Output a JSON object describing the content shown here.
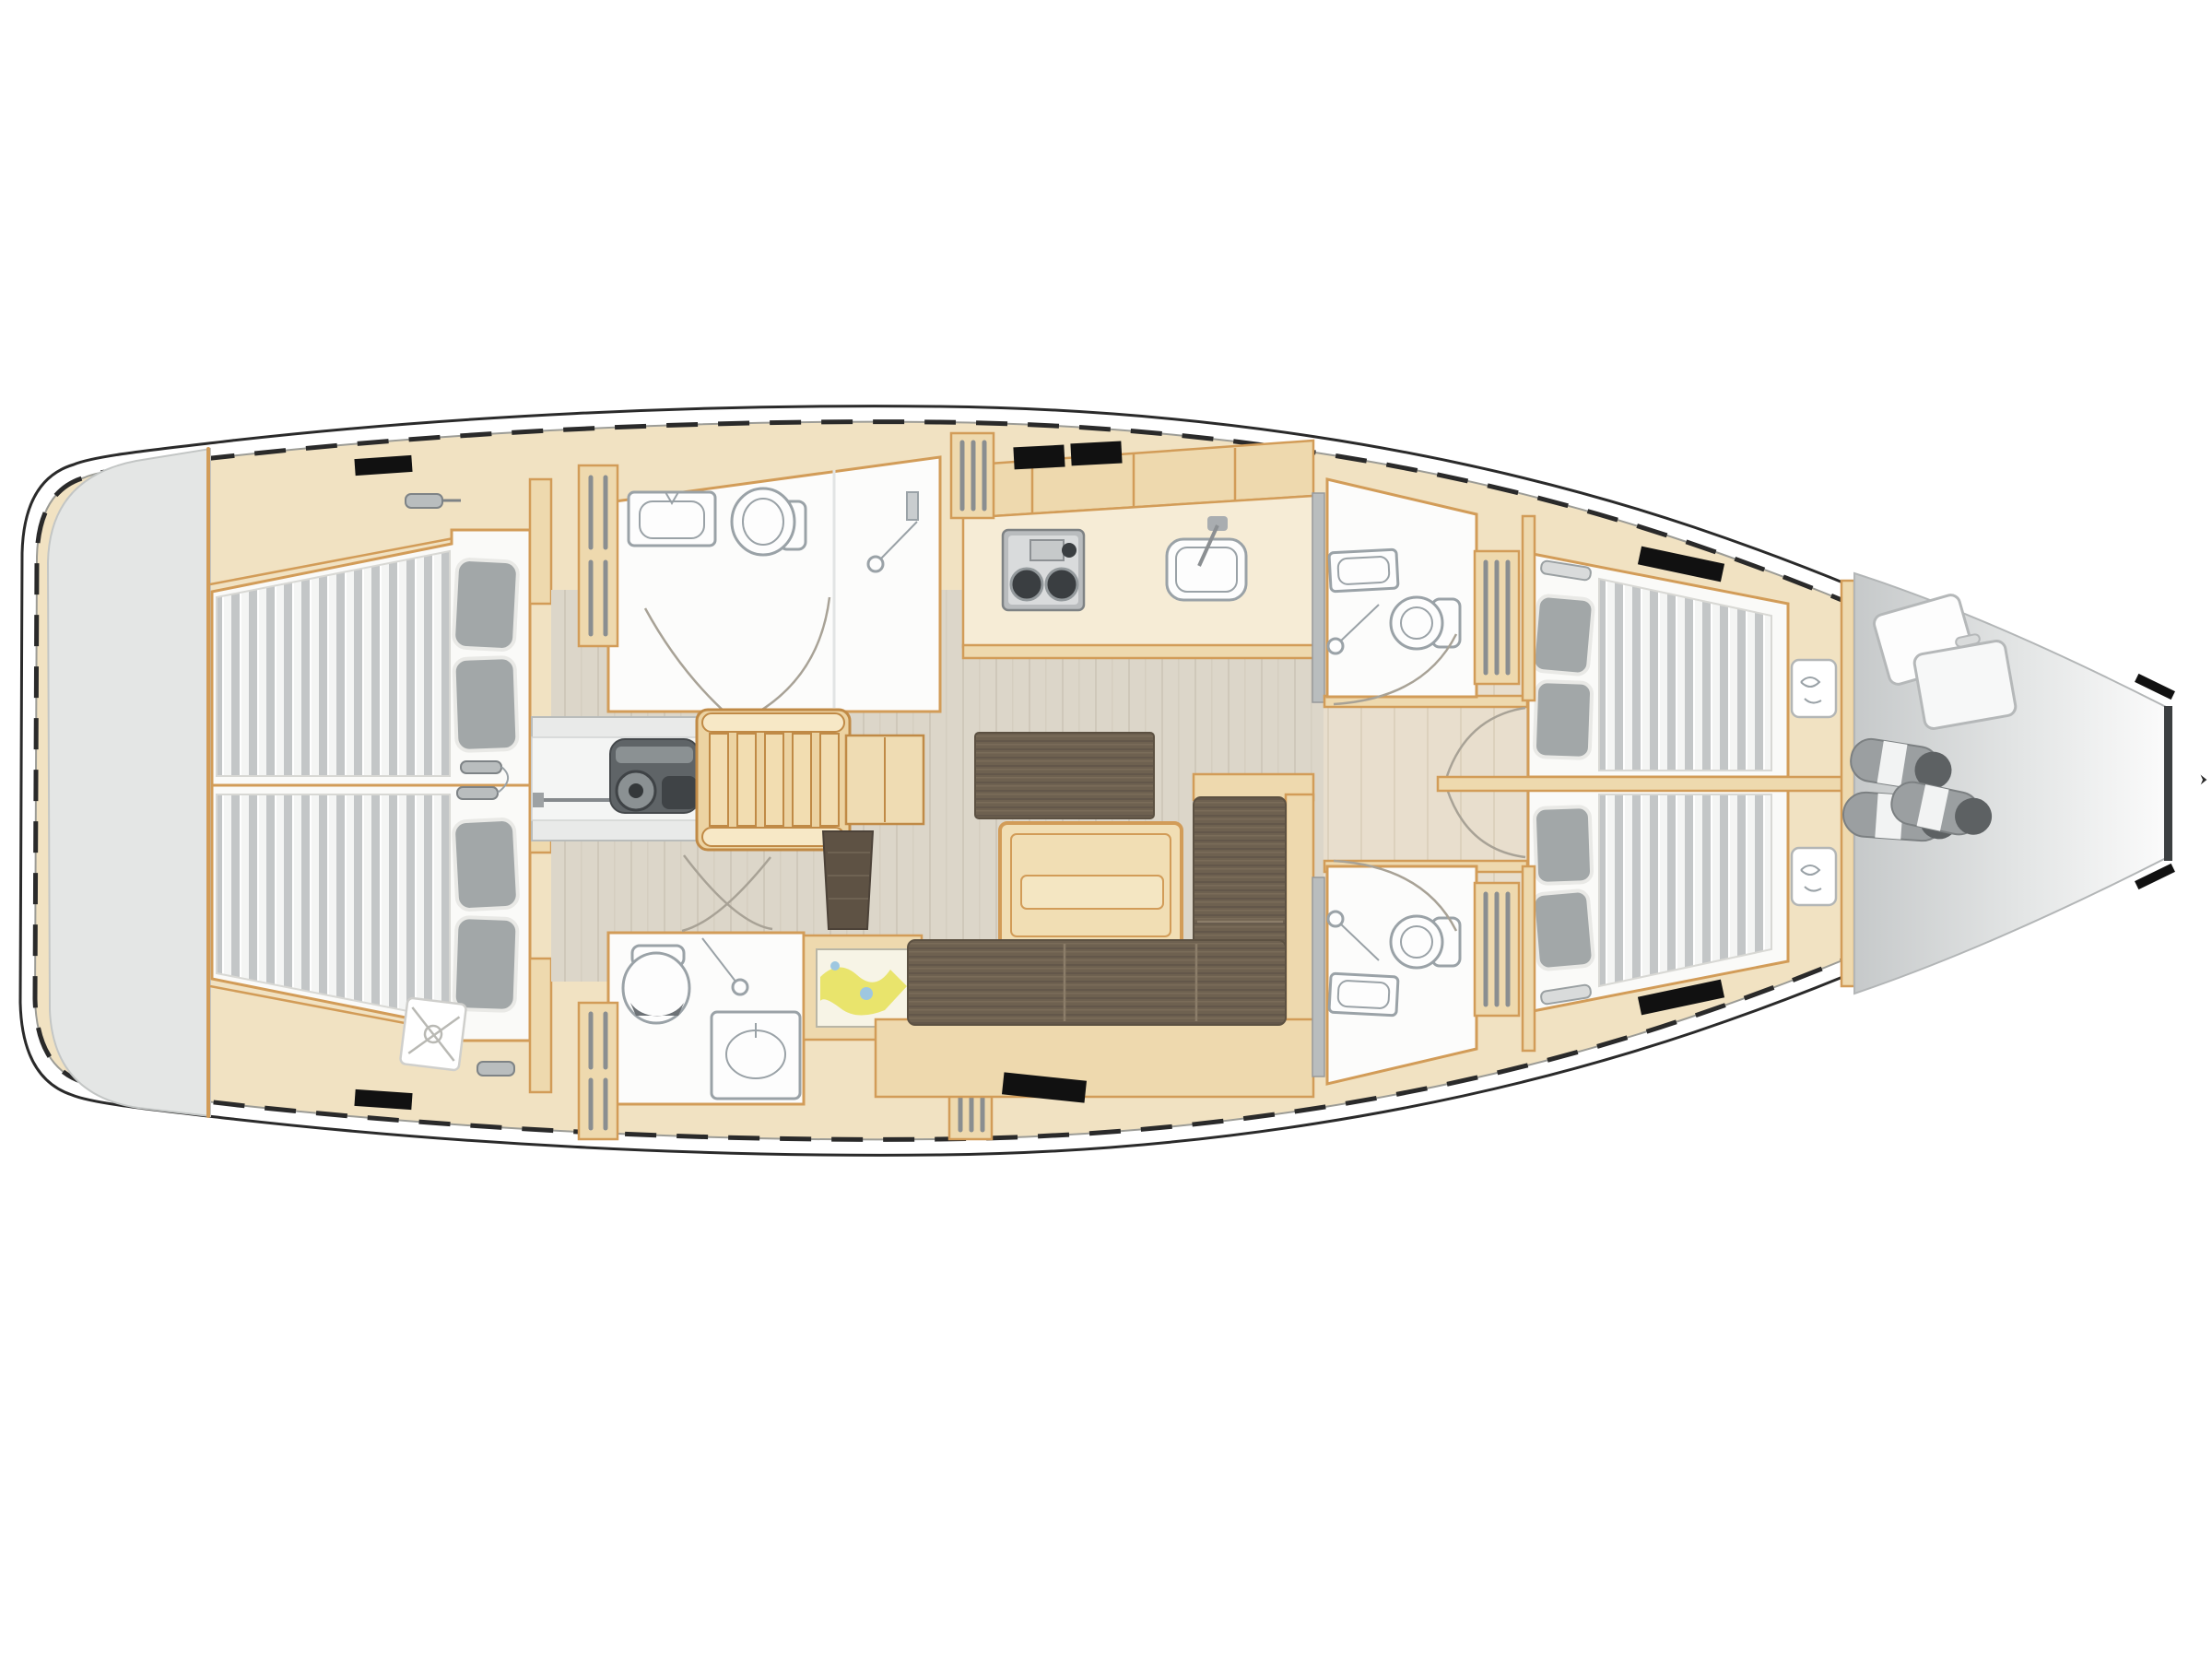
{
  "document": {
    "type": "sailing-yacht-interior-floor-plan",
    "view": "top-down deck plan",
    "orientation": "bow-right, stern-left",
    "visible_text": ""
  },
  "palette": {
    "page_bg": "#ffffff",
    "hull_line": "#2a2a2a",
    "hull_inner": "#9c9c96",
    "deck_wood": "#f1e2c2",
    "trim": "#d29c58",
    "wood_panel": "#eed9ae",
    "wood_light": "#f6ecd6",
    "floor_gray": "#dcd6c9",
    "floor_warm": "#e8decd",
    "cabin_white": "#fafaf8",
    "bath_white": "#fcfcfb",
    "gray_area": "#e4e6e5",
    "mattress_base": "#f4f5f4",
    "mattress_stripe": "#c3c6c7",
    "pillow": "#a2a7a8",
    "sofa_brown": "#6e6150",
    "sofa_line": "#5c5142",
    "table_wood": "#f1deb4",
    "fixture_fill": "#fdfdfd",
    "fixture_stroke": "#9aa2a7",
    "engine_dark": "#5f6467",
    "engine_mid": "#8b9193",
    "stove_gray": "#b9bcbe",
    "burner_dark": "#3a3e41",
    "partition_gray": "#b9bdbe",
    "locker_bar": "#8a8e90",
    "map_yellow": "#e9e46c",
    "map_paper": "#f7f4e6",
    "map_blue": "#9ec7e0",
    "sail_gray": "#c6c9ca",
    "roll_gray": "#9b9fa1",
    "roll_dark": "#5d6163",
    "hatch_black": "#111111",
    "arc_gray": "#a8a296"
  },
  "areas": [
    {
      "id": "transom-platform",
      "side": "stern"
    },
    {
      "id": "aft-cabin-port",
      "berths": 1,
      "features": [
        "double-berth",
        "pillows",
        "hanging-locker"
      ]
    },
    {
      "id": "aft-cabin-starboard",
      "berths": 1,
      "features": [
        "double-berth",
        "pillows",
        "vent-hatch"
      ]
    },
    {
      "id": "aft-head-port",
      "features": [
        "sink",
        "toilet",
        "shower"
      ]
    },
    {
      "id": "aft-head-starboard",
      "features": [
        "toilet",
        "shower",
        "sink"
      ]
    },
    {
      "id": "engine-compartment",
      "features": [
        "engine"
      ]
    },
    {
      "id": "companionway-stairs",
      "steps": 5
    },
    {
      "id": "nav-station",
      "features": [
        "chart-table",
        "seat"
      ]
    },
    {
      "id": "galley",
      "features": [
        "stove-2-burner",
        "sink",
        "counters",
        "lockers"
      ]
    },
    {
      "id": "salon",
      "features": [
        "sideboard",
        "dining-table",
        "l-shaped-sofa"
      ]
    },
    {
      "id": "forward-head-port",
      "features": [
        "sink",
        "toilet",
        "shower"
      ]
    },
    {
      "id": "forward-head-starboard",
      "features": [
        "sink",
        "toilet",
        "shower"
      ]
    },
    {
      "id": "forward-cabin-port",
      "berths": 1,
      "features": [
        "berth",
        "pillows",
        "nightstand",
        "louvered-locker"
      ]
    },
    {
      "id": "forward-cabin-starboard",
      "berths": 1,
      "features": [
        "berth",
        "pillows",
        "nightstand",
        "louvered-locker"
      ]
    },
    {
      "id": "sail-locker",
      "side": "bow",
      "features": [
        "sail-bag",
        "sail-rolls"
      ]
    }
  ]
}
